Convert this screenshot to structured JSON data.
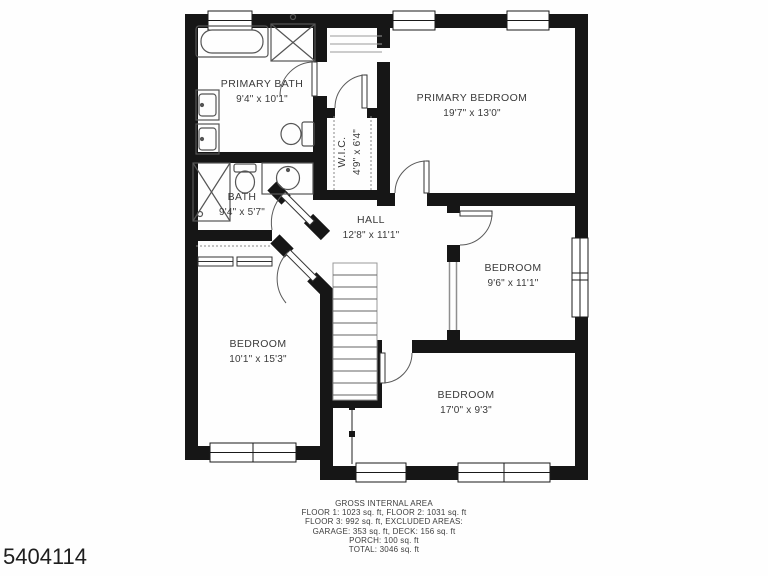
{
  "meta": {
    "photo_id": "5404114"
  },
  "rooms": {
    "primary_bath": {
      "name": "PRIMARY BATH",
      "dims": "9'4\" x 10'1\""
    },
    "primary_bedroom": {
      "name": "PRIMARY BEDROOM",
      "dims": "19'7\" x 13'0\""
    },
    "wic": {
      "name": "W.I.C.",
      "dims": "4'9\" x 6'4\""
    },
    "bath": {
      "name": "BATH",
      "dims": "9'4\" x 5'7\""
    },
    "hall": {
      "name": "HALL",
      "dims": "12'8\" x 11'1\""
    },
    "bedroom_right": {
      "name": "BEDROOM",
      "dims": "9'6\" x 11'1\""
    },
    "bedroom_left": {
      "name": "BEDROOM",
      "dims": "10'1\" x 15'3\""
    },
    "bedroom_bottom": {
      "name": "BEDROOM",
      "dims": "17'0\" x 9'3\""
    }
  },
  "footer": {
    "title": "GROSS INTERNAL AREA",
    "lines": [
      "FLOOR 1: 1023 sq. ft, FLOOR 2: 1031 sq. ft",
      "FLOOR 3: 992 sq. ft, EXCLUDED AREAS:",
      "GARAGE: 353 sq. ft, DECK: 156 sq. ft",
      "PORCH: 100 sq. ft",
      "TOTAL: 3046 sq. ft"
    ]
  },
  "colors": {
    "wall": "#161616",
    "fixture_line": "#555555",
    "thin_line": "#999999",
    "text": "#3a3a3a"
  }
}
